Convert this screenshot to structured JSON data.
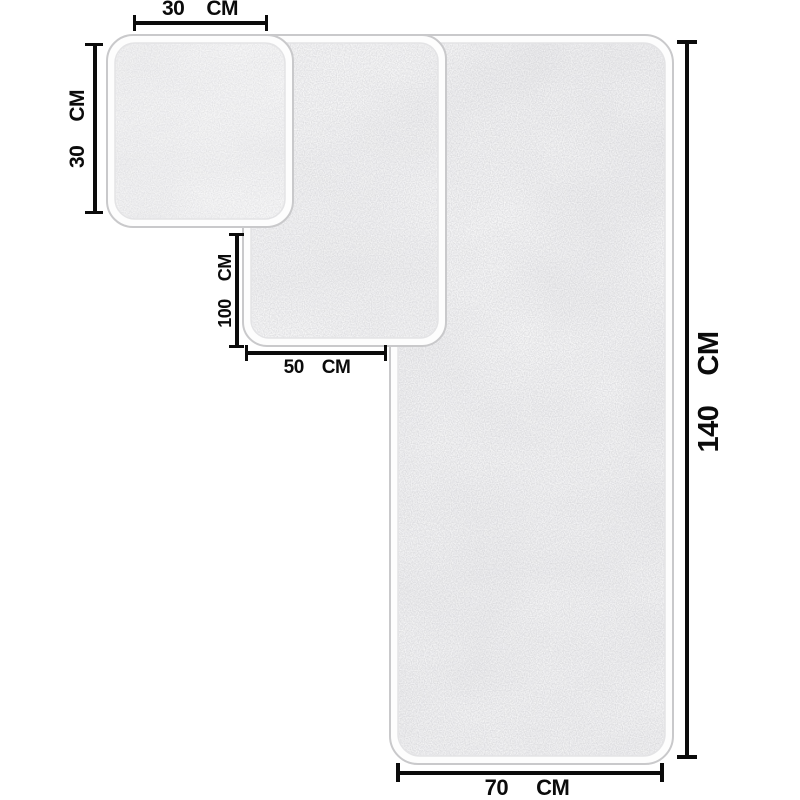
{
  "annotations": {
    "small_width": {
      "value": "30",
      "unit": "CM"
    },
    "small_height": {
      "value": "30",
      "unit": "CM"
    },
    "medium_height": {
      "value": "100",
      "unit": "CM"
    },
    "medium_width": {
      "value": "50",
      "unit": "CM"
    },
    "large_height": {
      "value": "140",
      "unit": "CM"
    },
    "large_width": {
      "value": "70",
      "unit": "CM"
    }
  },
  "towels": [
    {
      "id": "small",
      "width_cm": "30",
      "height_cm": "30"
    },
    {
      "id": "medium",
      "width_cm": "50",
      "height_cm": "100"
    },
    {
      "id": "large",
      "width_cm": "70",
      "height_cm": "140"
    }
  ],
  "colors": {
    "background": "#ffffff",
    "dimension_line": "#0b0b0b",
    "towel_fill": "#fdfdfd",
    "towel_outline": "#c9c9cb",
    "towel_inner_line": "#e3e3e5",
    "towel_texture": "#c2c2c6"
  }
}
